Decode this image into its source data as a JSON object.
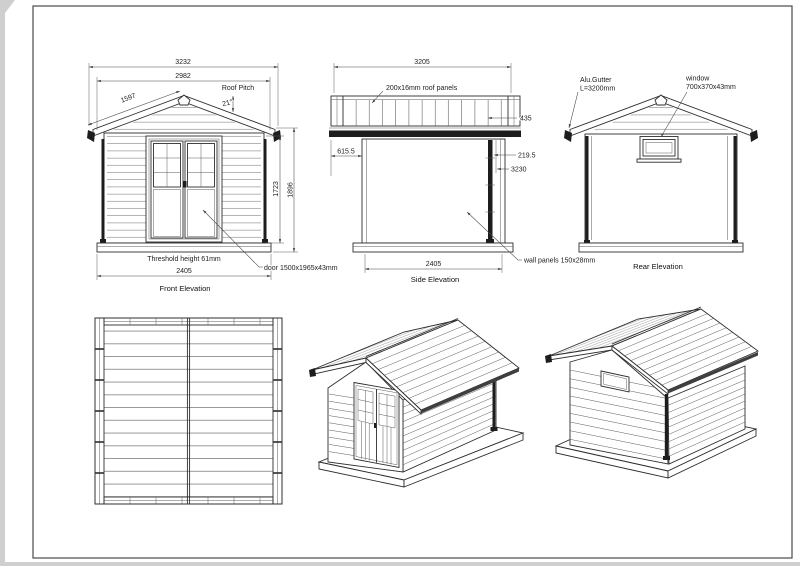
{
  "front": {
    "title": "Front Elevation",
    "dim_overall_width": "3232",
    "dim_roof_width": "2982",
    "dim_rafter": "1597",
    "roof_pitch_label": "Roof Pitch",
    "roof_pitch_value": "21°",
    "dim_wall_height": "1723",
    "dim_total_height": "1896",
    "dim_base_width": "2405",
    "threshold_note": "Threshold height  61mm",
    "door_note": "door 1500x1965x43mm"
  },
  "side": {
    "title": "Side Elevation",
    "dim_roof_length": "3205",
    "roof_panel_note": "200x16mm roof panels",
    "dim_roof_overhang": "435",
    "dim_eave_offset": "615.5",
    "dim_gutter_offset": "219.5",
    "dim_overall_length": "3230",
    "dim_wall_length": "2405",
    "wall_panel_note": "wall panels 150x28mm"
  },
  "rear": {
    "title": "Rear Elevation",
    "gutter_note_line1": "Alu.Gutter",
    "gutter_note_line2": "L=3200mm",
    "window_note_line1": "window",
    "window_note_line2": "700x370x43mm"
  }
}
